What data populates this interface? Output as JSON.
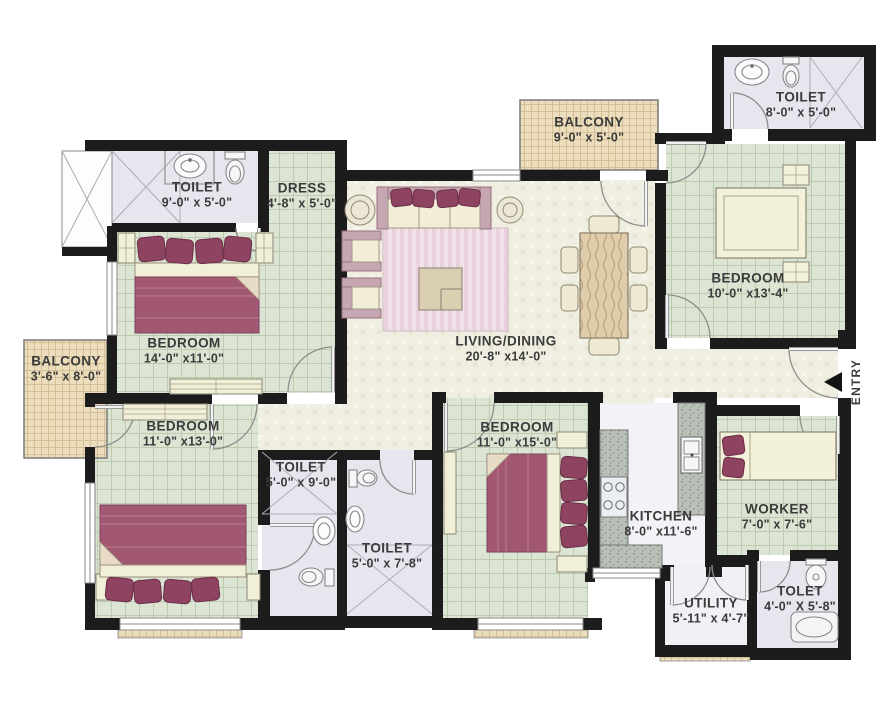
{
  "plan_type": "apartment-floor-plan",
  "colors": {
    "walls": "#1c1c1c",
    "tile_green": "#dce4d4",
    "tile_grid": "#bccaaf",
    "balcony_tan": "#ecdebc",
    "living_cream": "#f0eee1",
    "toilet_gray": "#e7e6ee",
    "kitchen_floor": "#f3f2f6",
    "counter_gray": "#b9c0b7",
    "furniture_maroon": "#a25873",
    "pillow_maroon": "#8e4461",
    "furniture_cream": "#f2efd9",
    "label_text": "#3b3b3b"
  },
  "rooms": {
    "toilet1": {
      "name": "TOILET",
      "dims": "9'-0\" x 5'-0\""
    },
    "dress": {
      "name": "DRESS",
      "dims": "4'-8\" x 5'-0\""
    },
    "balconyTop": {
      "name": "BALCONY",
      "dims": "9'-0\" x 5'-0\""
    },
    "toilet2": {
      "name": "TOILET",
      "dims": "8'-0\" x 5'-0\""
    },
    "bedroom1": {
      "name": "BEDROOM",
      "dims": "14'-0\" x11'-0\""
    },
    "balconyLeft": {
      "name": "BALCONY",
      "dims": "3'-6\" x 8'-0\""
    },
    "living": {
      "name": "LIVING/DINING",
      "dims": "20'-8\" x14'-0\""
    },
    "bedroomRight": {
      "name": "BEDROOM",
      "dims": "10'-0\" x13'-4\""
    },
    "bedroom2": {
      "name": "BEDROOM",
      "dims": "11'-0\" x13'-0\""
    },
    "toiletA": {
      "name": "TOILET",
      "dims": "5'-0\" x 9'-0\""
    },
    "bedroom3": {
      "name": "BEDROOM",
      "dims": "11'-0\" x15'-0\""
    },
    "toiletB": {
      "name": "TOILET",
      "dims": "5'-0\" x 7'-8\""
    },
    "kitchen": {
      "name": "KITCHEN",
      "dims": "8'-0\" x11'-6\""
    },
    "worker": {
      "name": "WORKER",
      "dims": "7'-0\" x 7'-6\""
    },
    "utility": {
      "name": "UTILITY",
      "dims": "5'-11\" x 4'-7\""
    },
    "toletBr": {
      "name": "TOLET",
      "dims": "4'-0\" X 5'-8\""
    },
    "entry": {
      "name": "ENTRY"
    }
  }
}
